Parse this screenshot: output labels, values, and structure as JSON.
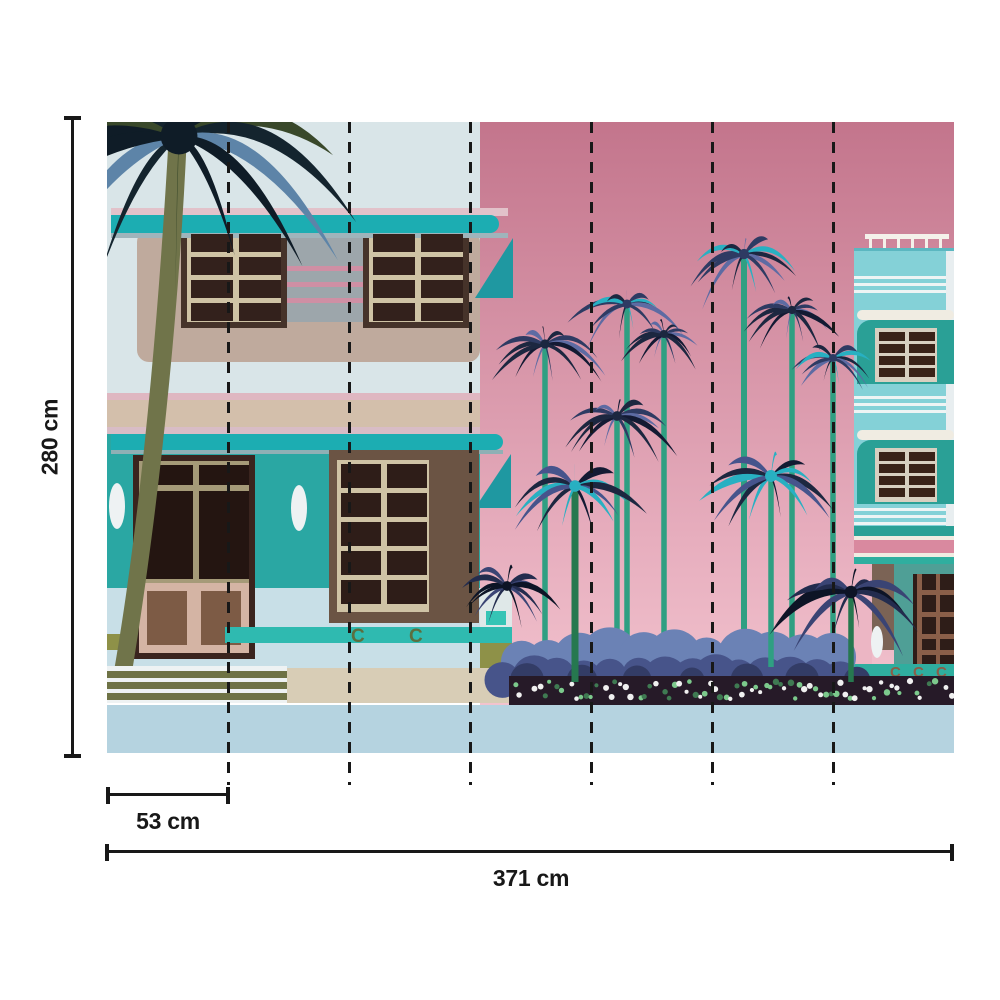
{
  "annotations": {
    "height_label": "280 cm",
    "height_cm": 280,
    "panel_width_label": "53 cm",
    "panel_width_cm": 53,
    "total_width_label": "371 cm",
    "total_width_cm": 371
  },
  "mural": {
    "subject": "Art Deco buildings with palm trees wall mural",
    "panel_count": 7,
    "panel_divider_count": 6,
    "ornaments": {
      "glyph": "C"
    },
    "palette": {
      "background": "#ffffff",
      "annotation": "#181818",
      "sky_pink_top": "#c3758c",
      "sky_pink_bottom": "#f2c3ce",
      "wall_pale_blue": "#d9e5e8",
      "teal_accent": "#1cadb2",
      "teal_wall": "#2aa7a3",
      "panel_taupe": "#bfaa9d",
      "band_beige": "#d3bfab",
      "stripe_pink": "#dfb7c1",
      "window_dark": "#33211c",
      "frame_beige": "#cfc3a5",
      "door_brown": "#2f1e19",
      "tower_turquoise": "#84d1d7",
      "awning_teal": "#2aa096",
      "band_pink": "#d9899f",
      "ground_teal": "#4f9f96",
      "pilaster_brown": "#7b6355",
      "street_blue": "#b5d3e0",
      "sidewalk_blue": "#c8dfe7",
      "bottom_beige": "#d8cdb6",
      "steps_olive": "#6e7245",
      "trunk_olive": "#70744a",
      "trunk_teal": "#2f9f82",
      "trunk_green": "#26784f",
      "bush_light": "#6b82b5",
      "bush_dark": "#47548a",
      "bush_deep": "#333c66",
      "bed_dark": "#261a28",
      "flower_white": "#f0f0f0",
      "flower_green": "#7cc98c",
      "variants": {
        "navy": [
          "#1c2740",
          "#2e3b63",
          "#5d6ba3",
          "#131a33"
        ],
        "navy_teal": [
          "#2e3b63",
          "#28b0c2",
          "#1c2740",
          "#5d6ba3"
        ],
        "teal": [
          "#28b0c2",
          "#1c2740",
          "#46548c",
          "#28b0c2",
          "#131a33"
        ],
        "dark": [
          "#0d1426",
          "#232c4e",
          "#3a4474"
        ],
        "left": [
          "#0f1c27",
          "#39482a",
          "#14242e",
          "#5d84a8",
          "#0f1c27"
        ]
      }
    },
    "scene": {
      "left_palm": {
        "x": 72,
        "y": 14,
        "r": 205,
        "fronds": 15,
        "variant": "left"
      },
      "palms": [
        {
          "x": 438,
          "y": 222,
          "r": 52,
          "trunk_to": 540,
          "variant": "navy",
          "layer": "mid"
        },
        {
          "x": 520,
          "y": 182,
          "r": 50,
          "trunk_to": 535,
          "variant": "navy_teal",
          "layer": "mid"
        },
        {
          "x": 557,
          "y": 212,
          "r": 40,
          "trunk_to": 535,
          "variant": "navy",
          "layer": "mid"
        },
        {
          "x": 510,
          "y": 294,
          "r": 54,
          "trunk_to": 540,
          "variant": "navy",
          "layer": "mid"
        },
        {
          "x": 637,
          "y": 132,
          "r": 57,
          "trunk_to": 540,
          "variant": "navy_teal",
          "tw": 6,
          "layer": "mid"
        },
        {
          "x": 685,
          "y": 188,
          "r": 46,
          "trunk_to": 538,
          "variant": "navy",
          "layer": "mid"
        },
        {
          "x": 726,
          "y": 236,
          "r": 42,
          "trunk_to": 536,
          "variant": "navy_teal",
          "layer": "mid"
        },
        {
          "x": 664,
          "y": 354,
          "r": 66,
          "trunk_to": 545,
          "variant": "teal",
          "layer": "front"
        },
        {
          "x": 468,
          "y": 364,
          "r": 64,
          "trunk_to": 560,
          "variant": "teal",
          "trunk": "trunk_green",
          "tw": 7,
          "layer": "front"
        },
        {
          "x": 400,
          "y": 464,
          "r": 54,
          "variant": "dark",
          "layer": "front"
        },
        {
          "x": 744,
          "y": 470,
          "r": 70,
          "trunk_to": 560,
          "variant": "dark",
          "trunk": "trunk_green",
          "layer": "front"
        }
      ],
      "bushes": {
        "x0": 400,
        "x1": 752,
        "top": 522
      },
      "flowerbed": {
        "x0": 402,
        "x1": 847,
        "y": 554,
        "h": 29
      }
    }
  }
}
